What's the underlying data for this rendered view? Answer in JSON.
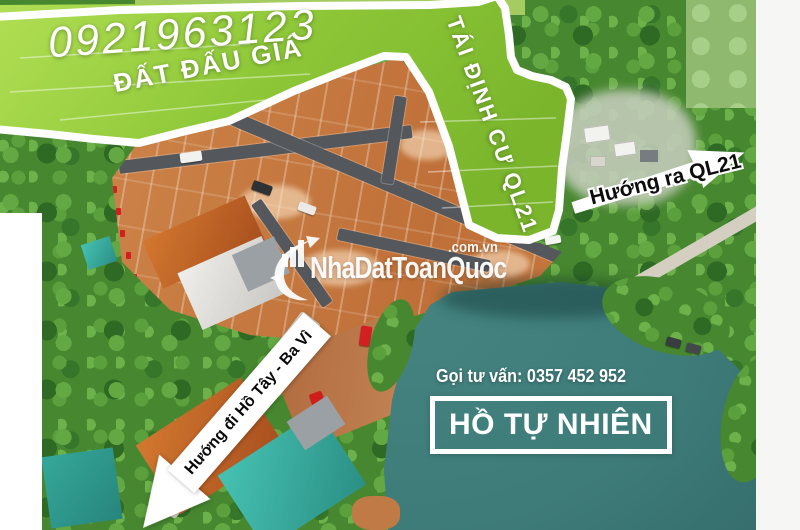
{
  "overlay": {
    "phone_number": "0921963123",
    "auction_label": "ĐẤT ĐẤU GIÁ",
    "resettlement_label": "TÁI ĐỊNH CƯ QL21",
    "direction_out_label": "Hướng ra QL21",
    "direction_road_label": "Hướng đi Hồ Tây - Ba Vì",
    "consultation_label": "Gọi tư vấn: 0357 452 952",
    "lake_label": "HỒ TỰ NHIÊN"
  },
  "watermark": {
    "brand": "NhaDatToanQuoc",
    "domain_suffix": ".com.vn",
    "logo_icon": "growth-swoosh-building-icon"
  },
  "icons": {
    "out_arrow": "block-arrow-right-icon",
    "road_arrow": "block-arrow-down-left-icon"
  },
  "colors": {
    "canvas_white": "#ffffff",
    "field_green": "#8ec838",
    "trees_green": "#47872f",
    "plot_dirt_orange": "#c67a3f",
    "asphalt_gray": "#54585c",
    "light_road": "#d5cfc2",
    "lake_teal": "#3e7c7a",
    "roof_orange": "#b5571f",
    "roof_teal": "#3ab3a4",
    "vehicle_red": "#d21f1f",
    "boundary_white": "#ffffff",
    "text_white": "#ffffff",
    "text_black": "#111111"
  }
}
